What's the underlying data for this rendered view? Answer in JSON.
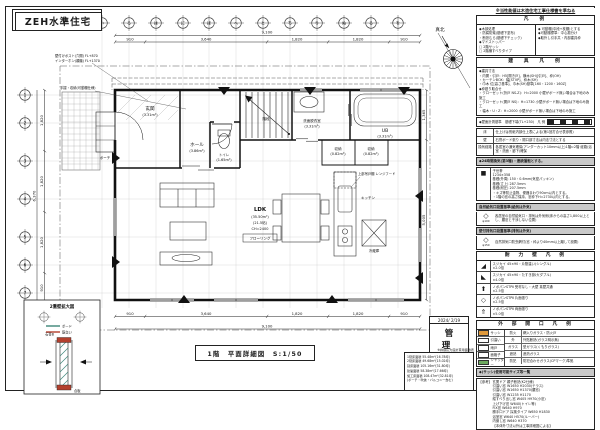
{
  "sheet": {
    "title": "ZEH水準住宅",
    "caption": "1階　平面詳細図　S:1/50",
    "north_label": "真北",
    "stamp": {
      "date": "2024/ 2/19",
      "label": "管 理"
    }
  },
  "grid": {
    "top_labels": [
      "い",
      "ろ",
      "は",
      "に",
      "ほ",
      "へ",
      "と",
      "ち",
      "り",
      "ぬ",
      "る",
      "を"
    ],
    "left_labels": [
      "1",
      "2",
      "3",
      "4",
      "5",
      "6",
      "7"
    ]
  },
  "dims": {
    "top_overall": "9,100",
    "top_segs": [
      "910",
      "3,640",
      "1,820",
      "1,820",
      "910"
    ],
    "bottom_overall": "9,100",
    "bottom_segs": [
      "910",
      "3,640",
      "1,820",
      "1,820",
      "910"
    ],
    "left_overall": "6,370",
    "left_segs": [
      "1,820",
      "1,820",
      "1,820",
      "910"
    ],
    "right_segs": [
      "1,365",
      "5,005"
    ]
  },
  "plan": {
    "rooms": {
      "genkan": {
        "name": "玄関",
        "area": "(3.31m²)"
      },
      "hall": {
        "name": "ホール",
        "area": "(3.86m²)"
      },
      "toilet": {
        "name": "トイレ",
        "area": "(1.65m²)"
      },
      "wash": {
        "name": "洗面脱衣室",
        "area": "(3.31m²)"
      },
      "bath": {
        "name": "UB",
        "area": "(3.31m²)"
      },
      "stor1": {
        "name": "収納",
        "area": "(0.82m²)"
      },
      "stor2": {
        "name": "収納",
        "area": "(0.82m²)"
      },
      "stair": {
        "name": "階段"
      },
      "ldk": {
        "name": "LDK",
        "area": "(35.50m²)",
        "jo": "(21.5帖)",
        "ch": "CH=2400",
        "finish": "フローリング"
      },
      "kitchen": {
        "name": "キッチン"
      },
      "fridge": {
        "name": "冷蔵庫"
      },
      "porch": {
        "name": "ポーチ"
      }
    },
    "notes": {
      "post": "壁付けポスト(穴開) FL+870",
      "intercom": "インターホン(親機) FL+1370",
      "shelf": "手摺・収納(可動棚仕様)",
      "hood": "上部吊戸棚 レンジフード"
    }
  },
  "detail2f": {
    "title": "2重壁拡大図",
    "legend": [
      {
        "label": "ボード",
        "color": "#3d8578"
      },
      {
        "label": "筋交い",
        "color": "#b3402e"
      }
    ],
    "note_left": "石膏B",
    "note_right": "合板"
  },
  "panel": {
    "disclaimer": "※当性能値は木造住宅工事仕様書を準ねる",
    "legend": {
      "title": "凡　例",
      "left": [
        "◆木部処理",
        "・防腐防蟻(基礎下塗布)",
        "・断熱むら(基礎下チェック)",
        "◆マドストッパー",
        "□ 2階サッシ",
        "□ 2階横すべりタイプ"
      ],
      "right": [
        "◆ 可動棚(中段+枕棚)とする",
        "◆可動棚標準：中心振分け",
        "◆取外し引手共・内部建具枠"
      ]
    },
    "fittings": {
      "title": "建　具　凡　例",
      "lines": [
        "◆建具寸法",
        "・内開・引戸：H5[開き戸]、横木(SH)[引戸]、枠(OH)",
        "・カーテンBOX：幅[STVP]、枠木(SH)",
        "・巾木 位[高さ基準]、巾木(SH)基準[160・1200・160Z]",
        "◆枠廻り取合せ",
        "・クローゼット(折戸 NS-Z)：H=2000 小壁がボード無い場合は下地のみ施工",
        "・クローゼット(開戸 NS)：H=1730 小壁がボード無い場合は下地のみ施工",
        "・幅木・U・Z：H=2000 小壁がボード無い場合は下地のみ施工"
      ]
    },
    "baseline": "◆壁面計測基準　基礎下端(TL+230)　凡 例",
    "finish_table": [
      {
        "k": "床",
        "v": "仕上げは別紙内部仕上表による(第1回打合せ表参照)"
      },
      {
        "k": "壁",
        "v": "石膏ボード張り・開口部寸法は内法寸法とする"
      },
      {
        "k": "換気経路",
        "v": "各居室の通気確保(アンダーカット10mm以上)1階⇔2階 経路(浴室・洗面・廊下)確保"
      }
    ],
    "vent_bar": "◆24時間換気(第3種)・連続運転とする。",
    "insul": {
      "icon": "■",
      "lines": [
        "子世帯",
        "1234×358",
        "基礎(外周) 150・0.6mm(気密パッキン)",
        "基礎(立上) 287.5mm",
        "基礎(耐圧) 207.5mm",
        "・キズ等防止金物、便器まわり90cm以内とする。",
        "・1階の窓の高さ保持、窓枠下H=2730以内とする。"
      ]
    },
    "supply": {
      "bar": "自然給気口設置基準(給気は外気)",
      "icon": "◇",
      "icon_label": "φ100",
      "text": "各居室の自然給気口・排気は外気側(床からの高さ1,800以上とし、腰窓と干渉しない位置)"
    },
    "exhaust": {
      "bar": "壁付排気口設置基準(排気は外気)",
      "icon": "◇",
      "icon_label": "φ150",
      "text": "自然排気口防虫網付(窓・枠より40mm以上離して設置)"
    },
    "bearing": {
      "title": "耐　力　壁　凡　例",
      "rows": [
        {
          "sym": "◢",
          "t1": "スジカイ 45×90・片筋違い(シングル)",
          "t2": "×2.0倍"
        },
        {
          "sym": "◣",
          "t1": "スジカイ 45×90・たすき掛け(ダブル)",
          "t2": "×4.0倍"
        },
        {
          "sym": "⬆",
          "t1": "ノボパンSTPⅡ 受材なし・大壁 真壁共通",
          "t2": "×2.5倍"
        },
        {
          "sym": "◇",
          "t1": "ノボパンSTPⅡ 片面張り",
          "t2": "×2.5倍"
        },
        {
          "sym": "⇑",
          "t1": "ノボパンSTPⅡ 両面張り",
          "t2": "×5.0倍"
        }
      ]
    },
    "openings": {
      "title": "外　部　開　口　凡　例",
      "swatches": [
        {
          "label": "サッシ",
          "color": "#e09a3c"
        },
        {
          "label": "引違い",
          "color": "#ffffff"
        },
        {
          "label": "雨戸",
          "color": "#ffffff"
        },
        {
          "label": "面格子",
          "color": "#ffffff"
        },
        {
          "label": "シャッター",
          "color": "#6da95f"
        }
      ],
      "rows": [
        {
          "k": "防火",
          "v": "網入りガラス・防火戸"
        },
        {
          "k": "外",
          "v": "外貼断熱(ガラス明示無)"
        },
        {
          "k": "ガラス",
          "v": "型ガラス(くもりガラス)"
        },
        {
          "k": "遮熱",
          "v": "遮熱ガラス"
        },
        {
          "k": "防犯",
          "v": "防犯合わせガラス(CPマーク)準拠"
        }
      ]
    },
    "sizes": {
      "bar": "◆(サッシ)使用可能サイズ等一覧",
      "tag": "【参考】",
      "lines": [
        "玄関ドア 親子断熱(K2仕様)",
        "引違い窓 W1650 H2030(テラス)",
        "引違い窓 W1650 H1370(腰窓)",
        "引違い窓 W1235 H1170",
        "縦すべり出し窓 W405 H970(小窓)",
        "上げ下げ窓 W640(トイレ等)",
        "FIX窓 W640 H970",
        "勝手口ドア 採風タイプ W650 H1830",
        "浴室窓 W640 H570(ルーバー)",
        "内倒し窓 W640 H370",
        "【本体外寸法以外は工事詳細図による】"
      ]
    }
  },
  "area_note": {
    "header": "※許容応力度計算用面積表",
    "lines": [
      "1階床面積 55.48m²(16.78坪)",
      "2階床面積 49.68m²(15.02坪)",
      "延床面積 105.16m²(31.80坪)",
      "建築面積 58.38m²(17.66坪)",
      "施工床面積 108.47m²(32.81坪)",
      "(ポーチ・吹抜・バルコニー含む)"
    ]
  }
}
